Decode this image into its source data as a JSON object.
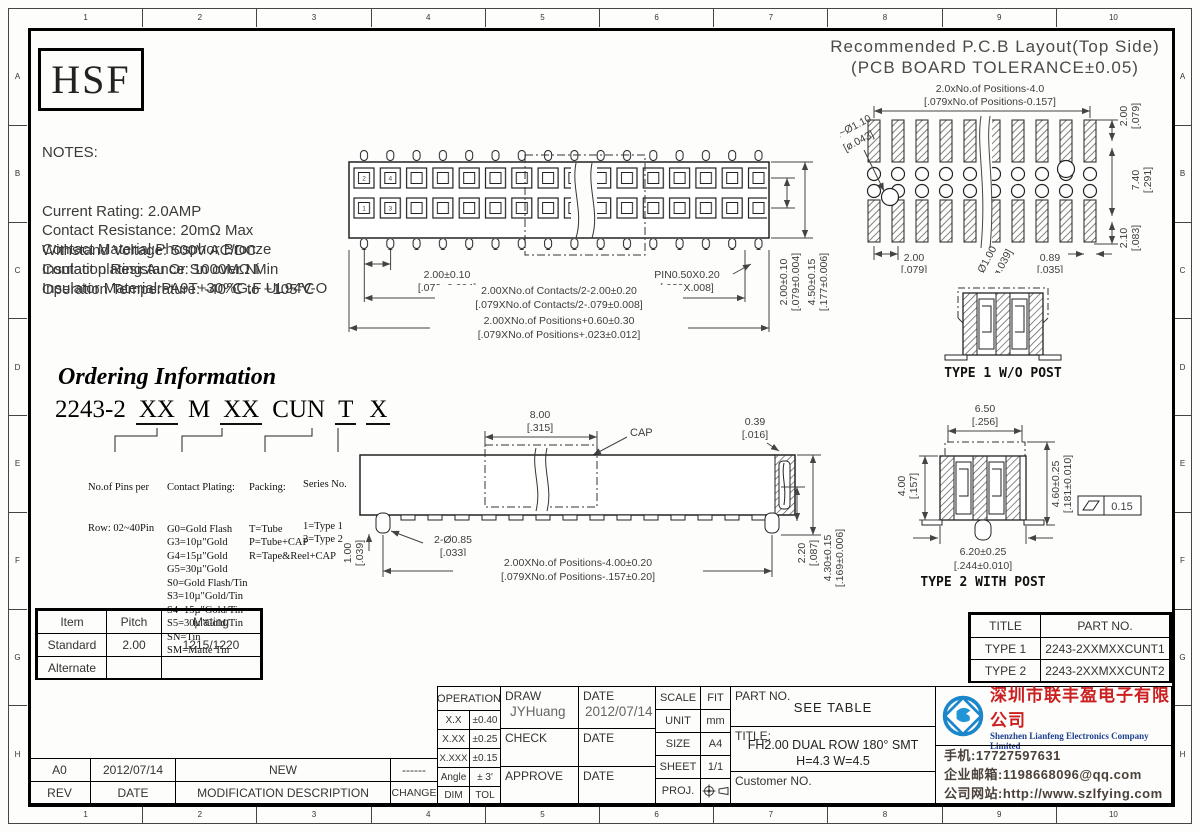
{
  "frame": {
    "top": [
      "1",
      "2",
      "3",
      "4",
      "5",
      "6",
      "7",
      "8",
      "9",
      "10"
    ],
    "bottom": [
      "1",
      "2",
      "3",
      "4",
      "5",
      "6",
      "7",
      "8",
      "9",
      "10"
    ],
    "left": [
      "A",
      "B",
      "C",
      "D",
      "E",
      "F",
      "G",
      "H"
    ],
    "right": [
      "A",
      "B",
      "C",
      "D",
      "E",
      "F",
      "G",
      "H"
    ]
  },
  "logo": {
    "text": "HSF"
  },
  "notes": {
    "heading": "NOTES:",
    "lines": [
      "Current Rating: 2.0AMP",
      "Contact Resistance: 20mΩ Max",
      "Withstand Voltage: 500V AC/DC",
      "Insulation Resistance: 1000MΩ Min",
      "Operation Temperature: -40℃ to +105℃"
    ],
    "materials": [
      "Contact Material:Phosphor Bronze",
      "Contact plating:Au Or Sn over Ni",
      "Insulator Material:PA9T+30%G.F UL94V-O"
    ]
  },
  "pcb_layout": {
    "title1": "Recommended P.C.B Layout(Top Side)",
    "title2": "(PCB BOARD TOLERANCE±0.05)",
    "dims": {
      "span_mm": "2.0xNo.of Positions-4.0",
      "span_in": "[.079xNo.of Positions-0.157]",
      "pitch_mm": "2.00",
      "pitch_in": "[.079]",
      "row_mm": "7.40",
      "row_in": "[.291]",
      "off_mm": "2.10",
      "off_in": "[.083]",
      "grid_mm": "2.00",
      "grid_in": "[.079]",
      "pad_mm": "0.89",
      "pad_in": "[.035]",
      "hole2_mm": "2~Ø1.10",
      "hole2_in": "[ø.043]",
      "hole1_mm": "Ø1.00",
      "hole1_in": "[ø.039]"
    }
  },
  "top_view": {
    "pin_numbers": [
      "2",
      "4",
      "1",
      "3"
    ],
    "dims": {
      "pitch_mm": "2.00±0.10",
      "pitch_in": "[.079±0.004]",
      "pin_mm": "PIN0.50X0.20",
      "pin_in": "[.020X.008]",
      "contacts_mm": "2.00XNo.of Contacts/2-2.00±0.20",
      "contacts_in": "[.079XNo.of Contacts/2-.079±0.008]",
      "positions_mm": "2.00XNo.of Positions+0.60±0.30",
      "positions_in": "[.079XNo.of Positions+.023±0.012]",
      "row_mm": "2.00±0.10",
      "row_in": "[.079±0.004]",
      "height_mm": "4.50±0.15",
      "height_in": "[.177±0.006]"
    }
  },
  "side_view": {
    "cap_label": "CAP",
    "dims": {
      "cap_mm": "8.00",
      "cap_in": "[.315]",
      "end_mm": "0.39",
      "end_in": "[.016]",
      "post_mm": "2-Ø0.85",
      "post_in": "[.033]",
      "posth_mm": "1.00",
      "posth_in": "[.039]",
      "span_mm": "2.00XNo.of Positions-4.00±0.20",
      "span_in": "[.079XNo.of Positions-.157±0.20]",
      "body_mm": "2.20",
      "body_in": "[.087]",
      "total_mm": "4.30±0.15",
      "total_in": "[.169±0.006]"
    }
  },
  "type1": {
    "label": "TYPE 1 W/O POST"
  },
  "type2": {
    "label": "TYPE 2 WITH POST",
    "dims": {
      "top_mm": "6.50",
      "top_in": "[.256]",
      "h_mm": "4.60±0.25",
      "h_in": "[.181±0.010]",
      "body_mm": "4.00",
      "body_in": "[.157]",
      "bottom_mm": "6.20±0.25",
      "bottom_in": "[.244±0.010]",
      "flatness": "0.15"
    }
  },
  "ordering": {
    "title": "Ordering Information",
    "code": [
      "2243-2",
      "XX",
      "M",
      "XX",
      "CUN",
      "T",
      "X"
    ],
    "pins": {
      "label1": "No.of Pins per",
      "label2": "Row: 02~40Pin"
    },
    "plating": {
      "label": "Contact Plating:",
      "options": [
        "G0=Gold Flash",
        "G3=10µ\"Gold",
        "G4=15µ\"Gold",
        "G5=30µ\"Gold",
        "S0=Gold Flash/Tin",
        "S3=10µ\"Gold/Tin",
        "S4=15µ\"Gold/Tin",
        "S5=30µ\"Gold/Tin",
        "SN=Tin",
        "SM=Matte Tin"
      ]
    },
    "packing": {
      "label": "Packing:",
      "options": [
        "T=Tube",
        "P=Tube+CAP",
        "R=Tape&Reel+CAP"
      ]
    },
    "series": {
      "label": "Series No.",
      "options": [
        "1=Type 1",
        "2=Type 2"
      ]
    }
  },
  "mating_table": {
    "headers": [
      "Item",
      "Pitch",
      "Mating"
    ],
    "rows": [
      [
        "Standard",
        "2.00",
        "1215/1220"
      ],
      [
        "Alternate",
        "",
        ""
      ]
    ]
  },
  "part_table": {
    "headers": [
      "TITLE",
      "PART NO."
    ],
    "rows": [
      [
        "TYPE 1",
        "2243-2XXMXXCUNT1"
      ],
      [
        "TYPE 2",
        "2243-2XXMXXCUNT2"
      ]
    ]
  },
  "title_block": {
    "operation": {
      "header": "OPERATION",
      "rows": [
        [
          "X.X",
          "±0.40"
        ],
        [
          "X.XX",
          "±0.25"
        ],
        [
          "X.XXX",
          "±0.15"
        ],
        [
          "Angle",
          "± 3'"
        ],
        [
          "DIM",
          "TOL"
        ]
      ]
    },
    "draw_label": "DRAW",
    "draw_value": "JYHuang",
    "date_label": "DATE",
    "draw_date": "2012/07/14",
    "check_label": "CHECK",
    "approve_label": "APPROVE",
    "scale_label": "SCALE",
    "scale_value": "FIT",
    "unit_label": "UNIT",
    "unit_value": "mm",
    "size_label": "SIZE",
    "size_value": "A4",
    "sheet_label": "SHEET",
    "sheet_value": "1/1",
    "proj_label": "PROJ.",
    "part_no_label": "PART NO.",
    "part_no_value": "SEE TABLE",
    "title_label": "TITLE:",
    "title_line1": "FH2.00 DUAL ROW 180° SMT",
    "title_line2": "H=4.3 W=4.5",
    "customer_label": "Customer NO."
  },
  "revision": {
    "headers": [
      "REV",
      "DATE",
      "MODIFICATION DESCRIPTION",
      "CHANGE"
    ],
    "row": [
      "A0",
      "2012/07/14",
      "NEW",
      "------"
    ]
  },
  "company": {
    "name_cn": "深圳市联丰盈电子有限公司",
    "name_en": "Shenzhen Lianfeng Electronics Company Limited",
    "phone": "手机:17727597631",
    "email": "企业邮箱:1198668096@qq.com",
    "website": "公司网站:http://www.szlfying.com",
    "colors": {
      "company_red": "#cc2020",
      "company_blue": "#1d3f8f",
      "logo_blue": "#1b86c9"
    }
  }
}
